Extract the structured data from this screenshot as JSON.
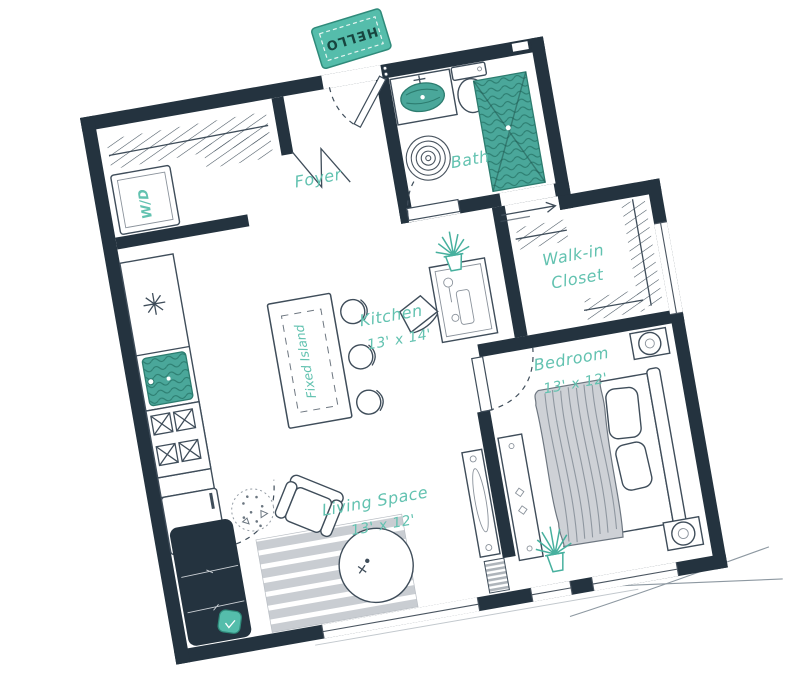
{
  "colors": {
    "wall": "#24333f",
    "teal": "#55bdab",
    "teal_dark": "#2c7c6f",
    "teal_text": "#62c2b0",
    "line": "#3f4d5a",
    "gray": "#ccd0d5",
    "rug_stripe": "#c9cdd2",
    "blanket": "#ced1d6"
  },
  "rooms": {
    "foyer": {
      "name": "Foyer"
    },
    "bath": {
      "name": "Bath"
    },
    "kitchen": {
      "name": "Kitchen",
      "dimensions": "13' x 14'"
    },
    "walk_in_closet": {
      "name_line1": "Walk-in",
      "name_line2": "Closet"
    },
    "bedroom": {
      "name": "Bedroom",
      "dimensions": "13' x 12'"
    },
    "living_space": {
      "name": "Living Space",
      "dimensions": "13' x 12'"
    }
  },
  "fixtures": {
    "doormat": {
      "text": "HELLO"
    },
    "laundry": {
      "label": "W/D"
    },
    "kitchen_island": {
      "label": "Fixed Island"
    }
  }
}
